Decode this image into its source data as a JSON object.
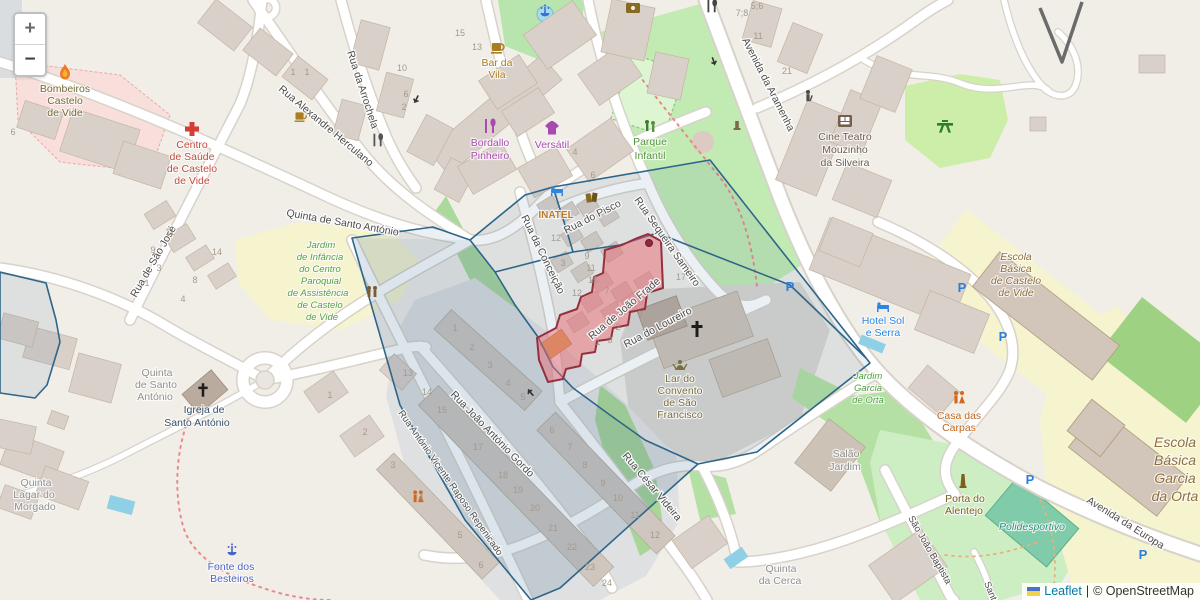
{
  "controls": {
    "zoom_in": "+",
    "zoom_out": "−"
  },
  "attribution": {
    "leaflet_link": "Leaflet",
    "separator": "|",
    "osm_text": "© OpenStreetMap"
  },
  "colors": {
    "overlay_blue_stroke": "#2e6588",
    "overlay_blue_fill": "rgba(58,105,145,0.10)",
    "overlay_red_stroke": "#96303f",
    "overlay_red_fill": "rgba(233,105,115,0.50)",
    "leaflet_link_blue": "#0078a8",
    "park_green": "#c2eab3",
    "school_yellow": "#f6f3cf",
    "pitch_teal": "#7fcbaa",
    "building_gray": "#d9d0c9",
    "water_blue": "#8fd0e6",
    "parking_blue": "#2a7fdc"
  },
  "map_icons": [
    "zoom-in",
    "zoom-out",
    "fire-station",
    "hospital",
    "cafe",
    "restaurant",
    "clothing-shop",
    "fountain",
    "playground",
    "cinema",
    "hotel-bed",
    "library-books",
    "church-cross",
    "kindergarten",
    "toilets",
    "picnic-site",
    "monument",
    "parking",
    "hairdresser",
    "statue",
    "ukraine-flag"
  ],
  "streets": {
    "alexandre_herculano": "Rua Alexandre Herculano",
    "arrochela": "Rua da Arrochela",
    "quinta_santo_antonio": "Quinta de Santo António",
    "sao_jose": "Rua de São José",
    "pisco": "Rua do Pisco",
    "sequeira_sameiro": "Rua Sequeira Sameiro",
    "conceicao": "Rua da Conceição",
    "joao_frade": "Rua de João Frade",
    "loureiro": "Rua do Loureiro",
    "joao_antonio_gordo": "Rua João António Gordo",
    "raposo_repenicado": "Rua António Vicente Raposo Repenicado",
    "cesar_videira": "Rua César Videira",
    "aramenha": "Avenida da Aramenha",
    "europa": "Avenida da Europa",
    "sao_joao_baptista": "São João Baptista",
    "santa": "Santa"
  },
  "pois": {
    "bombeiros": {
      "lines": [
        "Bombeiros",
        "Castelo",
        "de Vide"
      ]
    },
    "centro_saude": {
      "lines": [
        "Centro",
        "de Saúde",
        "de Castelo",
        "de Vide"
      ]
    },
    "bar_da_vila": {
      "lines": [
        "Bar da",
        "Vila"
      ]
    },
    "bordallo": {
      "lines": [
        "Bordallo",
        "Pinheiro"
      ]
    },
    "versatil": {
      "lines": [
        "Versátil"
      ]
    },
    "parque_infantil": {
      "lines": [
        "Parque",
        "Infantil"
      ]
    },
    "cine_teatro": {
      "lines": [
        "Cine Teatro",
        "Mouzinho",
        "da Silveira"
      ]
    },
    "inatel": {
      "lines": [
        "INATEL"
      ]
    },
    "jardim_infancia": {
      "lines": [
        "Jardim",
        "de Infância",
        "do Centro",
        "Paroquial",
        "de Assistência",
        "de Castelo",
        "de Vide"
      ]
    },
    "quinta_sto_antonio_farm": {
      "lines": [
        "Quinta",
        "de Santo",
        "António"
      ]
    },
    "igreja_sto_antonio": {
      "lines": [
        "Igreja de",
        "Santo António"
      ]
    },
    "quinta_lagar": {
      "lines": [
        "Quinta",
        "Lagar do",
        "Morgado"
      ]
    },
    "fonte_besteiros": {
      "lines": [
        "Fonte dos",
        "Besteiros"
      ]
    },
    "lar_convento": {
      "lines": [
        "Lar do",
        "Convento",
        "de São",
        "Francisco"
      ]
    },
    "salao_jardim": {
      "lines": [
        "Salão",
        "Jardim"
      ]
    },
    "jardim_garcia": {
      "lines": [
        "Jardim",
        "Garcia",
        "de Orta"
      ]
    },
    "casa_carpas": {
      "lines": [
        "Casa das",
        "Carpas"
      ]
    },
    "hotel_sol_serra": {
      "lines": [
        "Hotel Sol",
        "e Serra"
      ]
    },
    "escola_castelo_vide": {
      "lines": [
        "Escola",
        "Básica",
        "de Castelo",
        "de Vide"
      ]
    },
    "escola_garcia_orta": {
      "lines": [
        "Escola",
        "Básica",
        "Garcia",
        "da Orta"
      ]
    },
    "porta_alentejo": {
      "lines": [
        "Porta do",
        "Alentejo"
      ]
    },
    "polidesportivo": {
      "lines": [
        "Polidesportivo"
      ]
    },
    "quinta_cerca": {
      "lines": [
        "Quinta",
        "da Cerca"
      ]
    }
  },
  "parking": {
    "symbol": "P",
    "positions": [
      [
        790,
        291
      ],
      [
        962,
        292
      ],
      [
        1003,
        341
      ],
      [
        1030,
        484
      ],
      [
        1143,
        559
      ]
    ]
  },
  "house_numbers": [
    {
      "x": 293,
      "y": 75,
      "v": "1"
    },
    {
      "x": 307,
      "y": 75,
      "v": "1"
    },
    {
      "x": 402,
      "y": 71,
      "v": "10"
    },
    {
      "x": 406,
      "y": 97,
      "v": "6"
    },
    {
      "x": 404,
      "y": 110,
      "v": "2"
    },
    {
      "x": 460,
      "y": 36,
      "v": "15"
    },
    {
      "x": 477,
      "y": 50,
      "v": "13"
    },
    {
      "x": 575,
      "y": 155,
      "v": "4"
    },
    {
      "x": 742,
      "y": 16,
      "v": "7;8"
    },
    {
      "x": 757,
      "y": 9,
      "v": "5;6"
    },
    {
      "x": 758,
      "y": 39,
      "v": "11"
    },
    {
      "x": 787,
      "y": 74,
      "v": "21"
    },
    {
      "x": 13,
      "y": 135,
      "v": "6"
    },
    {
      "x": 170,
      "y": 235,
      "v": "11"
    },
    {
      "x": 153,
      "y": 253,
      "v": "9"
    },
    {
      "x": 159,
      "y": 271,
      "v": "3"
    },
    {
      "x": 147,
      "y": 286,
      "v": "1"
    },
    {
      "x": 217,
      "y": 255,
      "v": "14"
    },
    {
      "x": 195,
      "y": 283,
      "v": "8"
    },
    {
      "x": 183,
      "y": 302,
      "v": "4"
    },
    {
      "x": 408,
      "y": 376,
      "v": "13"
    },
    {
      "x": 330,
      "y": 398,
      "v": "1"
    },
    {
      "x": 365,
      "y": 435,
      "v": "2"
    },
    {
      "x": 593,
      "y": 178,
      "v": "6"
    },
    {
      "x": 556,
      "y": 241,
      "v": "12"
    },
    {
      "x": 563,
      "y": 266,
      "v": "3"
    },
    {
      "x": 587,
      "y": 259,
      "v": "9"
    },
    {
      "x": 591,
      "y": 271,
      "v": "11"
    },
    {
      "x": 593,
      "y": 283,
      "v": "15"
    },
    {
      "x": 577,
      "y": 296,
      "v": "12"
    },
    {
      "x": 607,
      "y": 294,
      "v": "7"
    },
    {
      "x": 640,
      "y": 317,
      "v": "9"
    },
    {
      "x": 618,
      "y": 330,
      "v": "2"
    },
    {
      "x": 681,
      "y": 280,
      "v": "17"
    },
    {
      "x": 598,
      "y": 345,
      "v": "1"
    },
    {
      "x": 610,
      "y": 343,
      "v": "3"
    },
    {
      "x": 455,
      "y": 331,
      "v": "1"
    },
    {
      "x": 472,
      "y": 350,
      "v": "2"
    },
    {
      "x": 490,
      "y": 368,
      "v": "3"
    },
    {
      "x": 508,
      "y": 386,
      "v": "4"
    },
    {
      "x": 523,
      "y": 400,
      "v": "5"
    },
    {
      "x": 427,
      "y": 395,
      "v": "14"
    },
    {
      "x": 442,
      "y": 413,
      "v": "15"
    },
    {
      "x": 478,
      "y": 450,
      "v": "17"
    },
    {
      "x": 503,
      "y": 478,
      "v": "18"
    },
    {
      "x": 518,
      "y": 493,
      "v": "19"
    },
    {
      "x": 535,
      "y": 511,
      "v": "20"
    },
    {
      "x": 553,
      "y": 531,
      "v": "21"
    },
    {
      "x": 572,
      "y": 550,
      "v": "22"
    },
    {
      "x": 590,
      "y": 570,
      "v": "23"
    },
    {
      "x": 607,
      "y": 586,
      "v": "24"
    },
    {
      "x": 552,
      "y": 433,
      "v": "6"
    },
    {
      "x": 570,
      "y": 450,
      "v": "7"
    },
    {
      "x": 585,
      "y": 468,
      "v": "8"
    },
    {
      "x": 603,
      "y": 486,
      "v": "9"
    },
    {
      "x": 618,
      "y": 501,
      "v": "10"
    },
    {
      "x": 635,
      "y": 518,
      "v": "11"
    },
    {
      "x": 655,
      "y": 538,
      "v": "12"
    },
    {
      "x": 393,
      "y": 468,
      "v": "3"
    },
    {
      "x": 421,
      "y": 500,
      "v": "4"
    },
    {
      "x": 460,
      "y": 538,
      "v": "5"
    },
    {
      "x": 481,
      "y": 568,
      "v": "6"
    }
  ]
}
